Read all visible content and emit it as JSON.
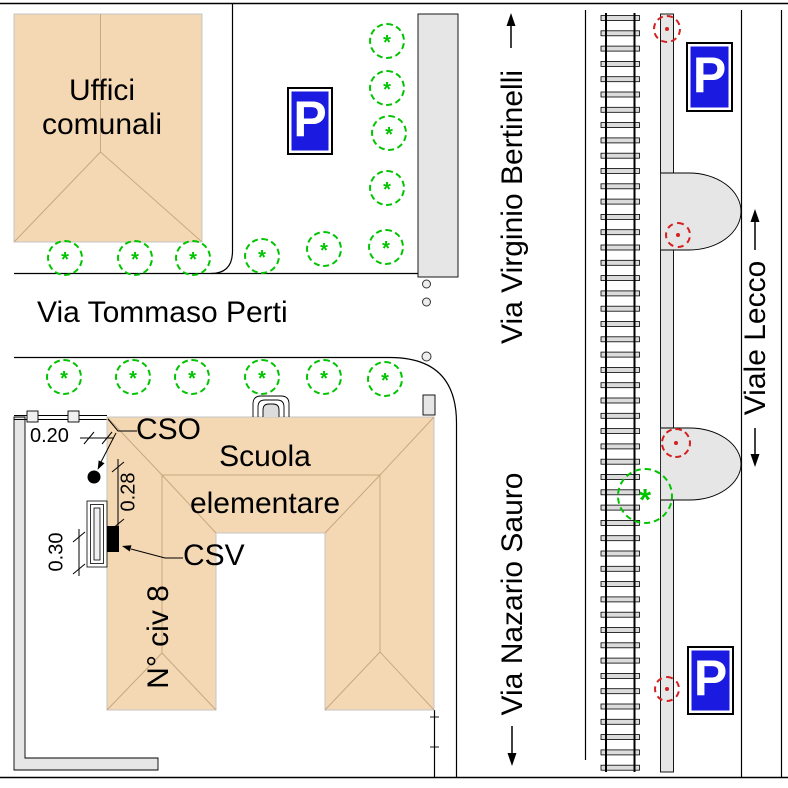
{
  "drawing": {
    "buildings": {
      "uffici_comunali": {
        "label": "Uffici\ncomunali"
      },
      "scuola_elementare": {
        "label": "Scuola\nelementare",
        "civic_number": "N° civ 8"
      }
    },
    "streets": {
      "tommaso_perti": {
        "name": "Via Tommaso Perti"
      },
      "virginio_bertinelli": {
        "name": "Via Virginio Bertinelli",
        "direction": "up"
      },
      "nazario_sauro": {
        "name": "Via Nazario Sauro",
        "direction": "down"
      },
      "viale_lecco": {
        "name": "Viale Lecco",
        "direction": "both"
      }
    },
    "annotations": {
      "cso": {
        "label": "CSO"
      },
      "csv": {
        "label": "CSV"
      },
      "dimensions": [
        {
          "label": "0.20",
          "orientation": "horizontal"
        },
        {
          "label": "0.28",
          "orientation": "vertical"
        },
        {
          "label": "0.30",
          "orientation": "vertical"
        }
      ]
    },
    "parking_signs": [
      {
        "label": "P",
        "x": 287,
        "y": 87,
        "w": 46,
        "h": 68
      },
      {
        "label": "P",
        "x": 686,
        "y": 42,
        "w": 47,
        "h": 70
      },
      {
        "label": "P",
        "x": 687,
        "y": 646,
        "w": 47,
        "h": 69
      }
    ],
    "trees": {
      "green": [
        [
          387,
          41
        ],
        [
          387,
          88
        ],
        [
          389,
          133
        ],
        [
          387,
          188
        ],
        [
          386,
          247
        ],
        [
          324,
          249
        ],
        [
          262,
          256
        ],
        [
          193,
          258
        ],
        [
          135,
          258
        ],
        [
          65,
          258
        ],
        [
          64,
          377
        ],
        [
          133,
          377
        ],
        [
          192,
          377
        ],
        [
          262,
          377
        ],
        [
          324,
          377
        ],
        [
          385,
          379
        ],
        [
          645,
          496,
          56
        ]
      ],
      "red": [
        [
          667,
          29,
          28
        ],
        [
          678,
          235,
          26
        ],
        [
          676,
          443,
          30
        ],
        [
          667,
          689,
          26
        ]
      ]
    },
    "railway": {
      "x": 601,
      "width": 38.5,
      "y_start": 18,
      "y_end": 770,
      "tie_spacing": 15.3
    },
    "colors": {
      "building_fill": "#F4D8B4",
      "roof_line": "#C8A87E",
      "sidewalk_fill": "#E6E6E6",
      "tree_green": "#00C400",
      "tree_red": "#D42020",
      "sign_blue": "#1A1AE0"
    }
  }
}
